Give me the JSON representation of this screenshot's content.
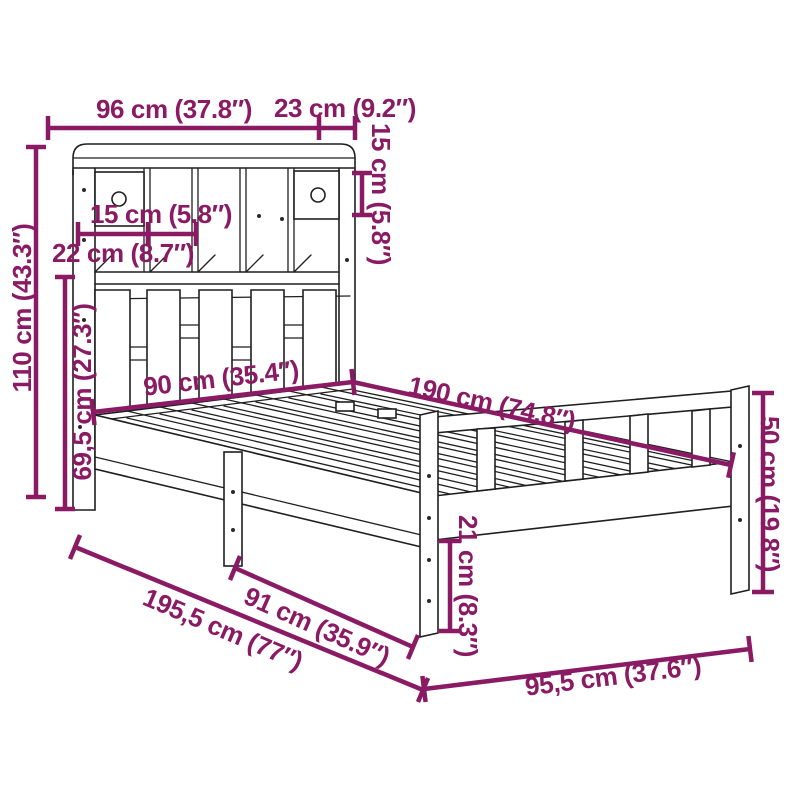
{
  "figure": {
    "kind": "product-dimension-diagram",
    "subject": "bookcase-bed-frame-line-drawing"
  },
  "colors": {
    "dimension": "#8a1a64",
    "line_art": "#1f1f1f",
    "background": "#ffffff"
  },
  "dims": [
    {
      "name": "bookcase-top-width",
      "label": "96 cm (37.8″)"
    },
    {
      "name": "bookcase-top-depth",
      "label": "23 cm (9.2″)"
    },
    {
      "name": "top-shelf-height",
      "label": "15 cm (5.8″)"
    },
    {
      "name": "cubby-width",
      "label": "15 cm (5.8″)"
    },
    {
      "name": "drawer-compartment-width",
      "label": "22 cm (8.7″)"
    },
    {
      "name": "headboard-total-height",
      "label": "110 cm (43.3″)"
    },
    {
      "name": "headboard-lower-height",
      "label": "69,5 cm (27.3″)"
    },
    {
      "name": "bed-inner-width",
      "label": "90 cm (35.4″)"
    },
    {
      "name": "bed-inner-length",
      "label": "190 cm (74.8″)"
    },
    {
      "name": "footboard-height",
      "label": "50 cm (19.8″)"
    },
    {
      "name": "under-bed-clearance",
      "label": "21 cm (8.3″)"
    },
    {
      "name": "total-length",
      "label": "195,5 cm (77″)"
    },
    {
      "name": "floor-inner-length",
      "label": "91 cm (35.9″)"
    },
    {
      "name": "total-width",
      "label": "95,5 cm (37.6″)"
    }
  ]
}
